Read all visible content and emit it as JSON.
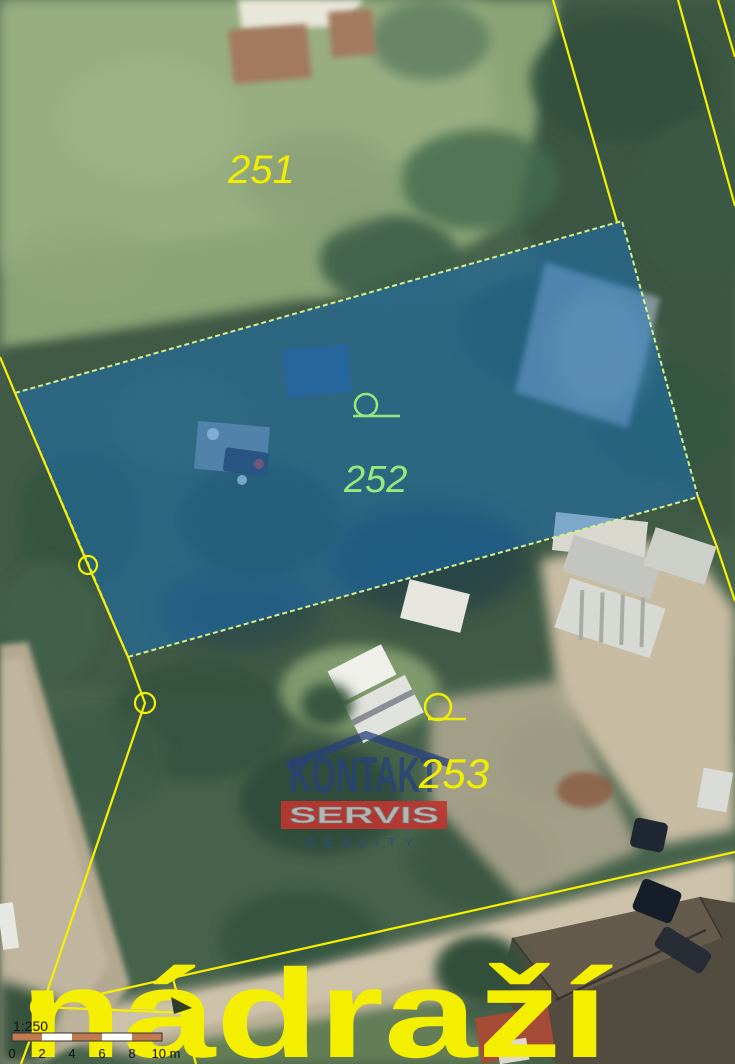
{
  "map": {
    "place_label": "nádraží",
    "scale_text": "1:250",
    "scale_bar_labels": [
      "0",
      "2",
      "4",
      "6",
      "8",
      "10 m"
    ],
    "parcel_labels": {
      "p251": "251",
      "p252": "252",
      "p253": "253"
    },
    "colors": {
      "boundary_line": "#f6f000",
      "highlight_fill_rgba": "rgba(25,115,195,0.48)",
      "highlight_stroke": "#d6ef8a",
      "label_default": "#f0ee00",
      "label_highlighted": "#97e87d",
      "scalebar_orange": "#bf7a52",
      "scalebar_white": "#ffffff",
      "scale_text_color": "#101010",
      "place_label_color": "#f4ee00"
    }
  },
  "watermark": {
    "brand_top": "KONTAKT",
    "brand_mid": "SERVIS",
    "brand_bottom": "REALITY",
    "roof_color": "#28427c",
    "box_color": "#c03530"
  }
}
